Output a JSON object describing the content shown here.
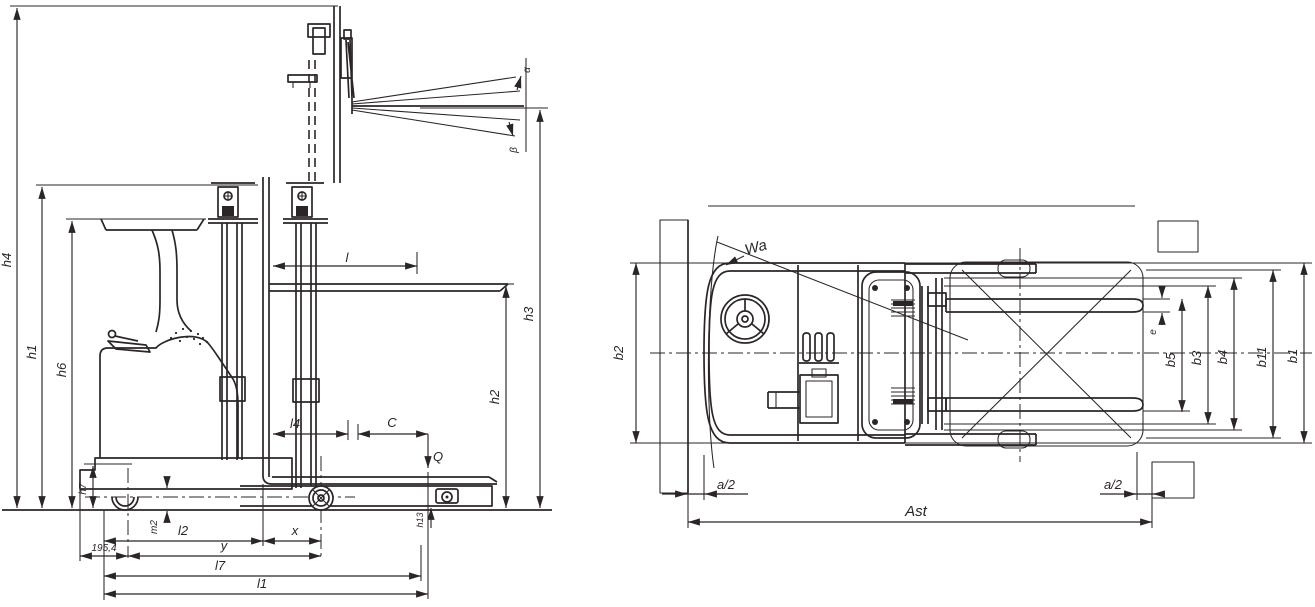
{
  "colors": {
    "line": "#2b2527",
    "background": "#ffffff"
  },
  "side_view": {
    "heights": {
      "h1": "h1",
      "h2": "h2",
      "h3": "h3",
      "h4": "h4",
      "h6": "h6",
      "h7": "h7",
      "h13": "h13",
      "m2": "m2"
    },
    "lengths": {
      "l": "l",
      "l1": "l1",
      "l2": "l2",
      "l4": "l4",
      "l7": "l7",
      "x": "x",
      "y": "y",
      "c": "C",
      "rear_axle_offset": "195,4"
    },
    "load_arrow": "Q",
    "tilt_angles": {
      "alpha": "α",
      "beta": "β"
    }
  },
  "top_view": {
    "widths": {
      "b1": "b1",
      "b2": "b2",
      "b3": "b3",
      "b4": "b4",
      "b5": "b5",
      "b11": "b11",
      "e": "e"
    },
    "aisle": {
      "ast": "Ast",
      "a2_left": "a/2",
      "a2_right": "a/2",
      "turning_radius": "Wa"
    }
  }
}
